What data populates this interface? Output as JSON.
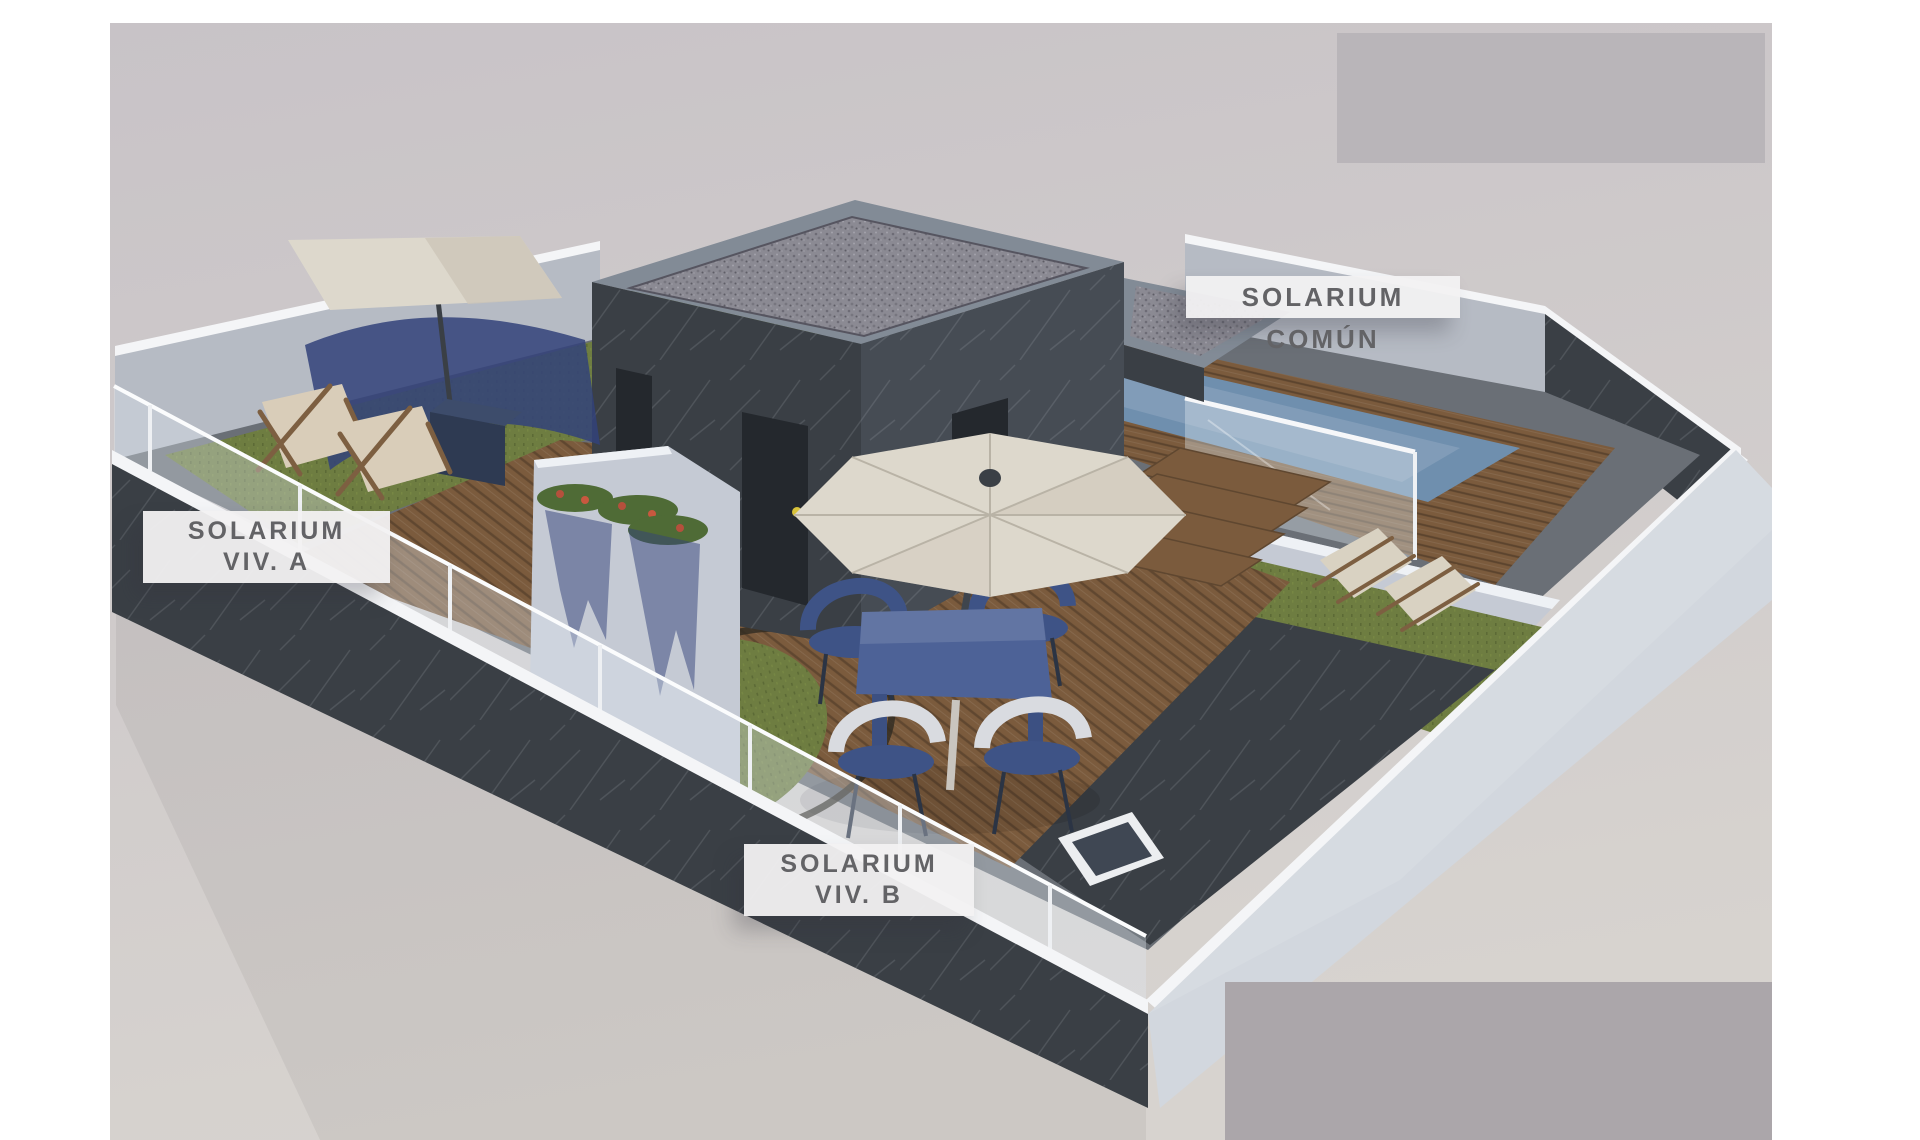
{
  "rendering": {
    "description": "3D rooftop solarium architectural rendering",
    "labels": {
      "common": "SOLARIUM COMÚN",
      "viv_a": {
        "line1": "SOLARIUM",
        "line2": "VIV. A"
      },
      "viv_b": {
        "line1": "SOLARIUM",
        "line2": "VIV. B"
      }
    },
    "palette": {
      "photo_bg_top": "#c8c3c7",
      "photo_bg_bottom": "#d7d3cf",
      "masked_top_right": "#b9b5b9",
      "masked_bottom_right": "#aba6aa",
      "dark_wall": "#3a3f45",
      "dark_wall_light": "#464c54",
      "light_wall_inner": "#b6bbc4",
      "light_wall_outer": "#d2d7de",
      "coping_white": "#f4f5f7",
      "glass": "#dfe9f0",
      "grass": "#6e7d41",
      "wood_deck": "#7b5b3d",
      "wood_dark": "#5f4730",
      "pool_water": "#6f8fae",
      "pool_water_light": "#96aec6",
      "gravel": "#8b8a93",
      "umbrella": "#ddd8cc",
      "umbrella_shade": "#cdc6b8",
      "table_blue": "#4d6297",
      "chair_navy": "#3e5386",
      "chair_white": "#d9dbe0",
      "stucco": "#c5cad4",
      "shadow_navy": "#33427a",
      "planter_navy": "#2e3a52",
      "flower_green": "#4f6b36",
      "flower_red": "#b5503c",
      "wood_frame": "#7d5f41",
      "door_dark": "#24282d",
      "handle_yellow": "#d8c23a"
    }
  }
}
